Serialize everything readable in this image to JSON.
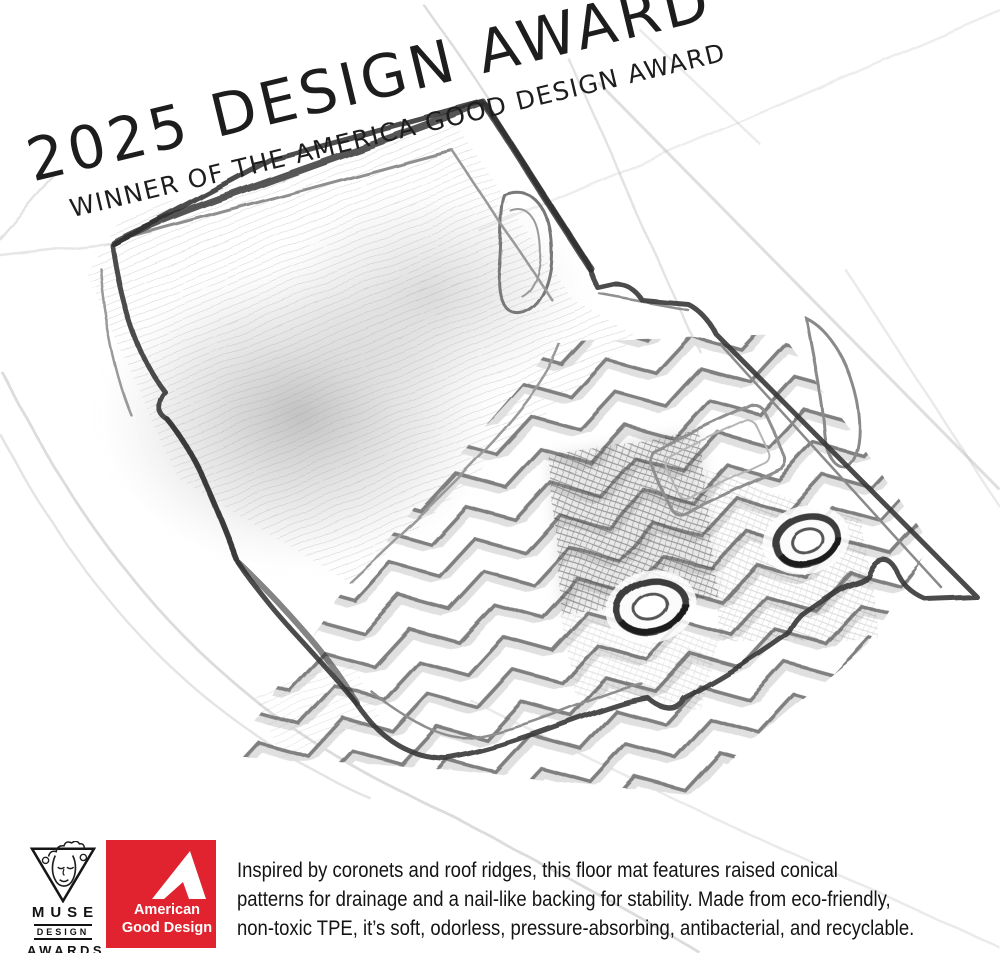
{
  "award_banner": {
    "title": "2025 DESIGN AWARD",
    "subtitle": "WINNER OF THE AMERICA GOOD DESIGN AWARD"
  },
  "logos": {
    "muse": {
      "line1": "MUSE",
      "line2": "DESIGN",
      "line3": "AWARDS"
    },
    "american_good_design": {
      "line1": "American",
      "line2": "Good Design",
      "bg_color": "#E0232E"
    }
  },
  "description": {
    "lines": [
      "Inspired by coronets and roof ridges, this floor mat features raised conical",
      "patterns for drainage and a nail-like backing for stability. Made from eco-friendly,",
      "non-toxic TPE, it’s soft, odorless, pressure-absorbing, antibacterial, and recyclable."
    ]
  },
  "illustration": {
    "subject": "pencil sketch of a car floor mat with chevron ridge pattern",
    "pencil_stroke_color": "#3a3a3a",
    "grid_line_color": "#b9b9b9"
  }
}
